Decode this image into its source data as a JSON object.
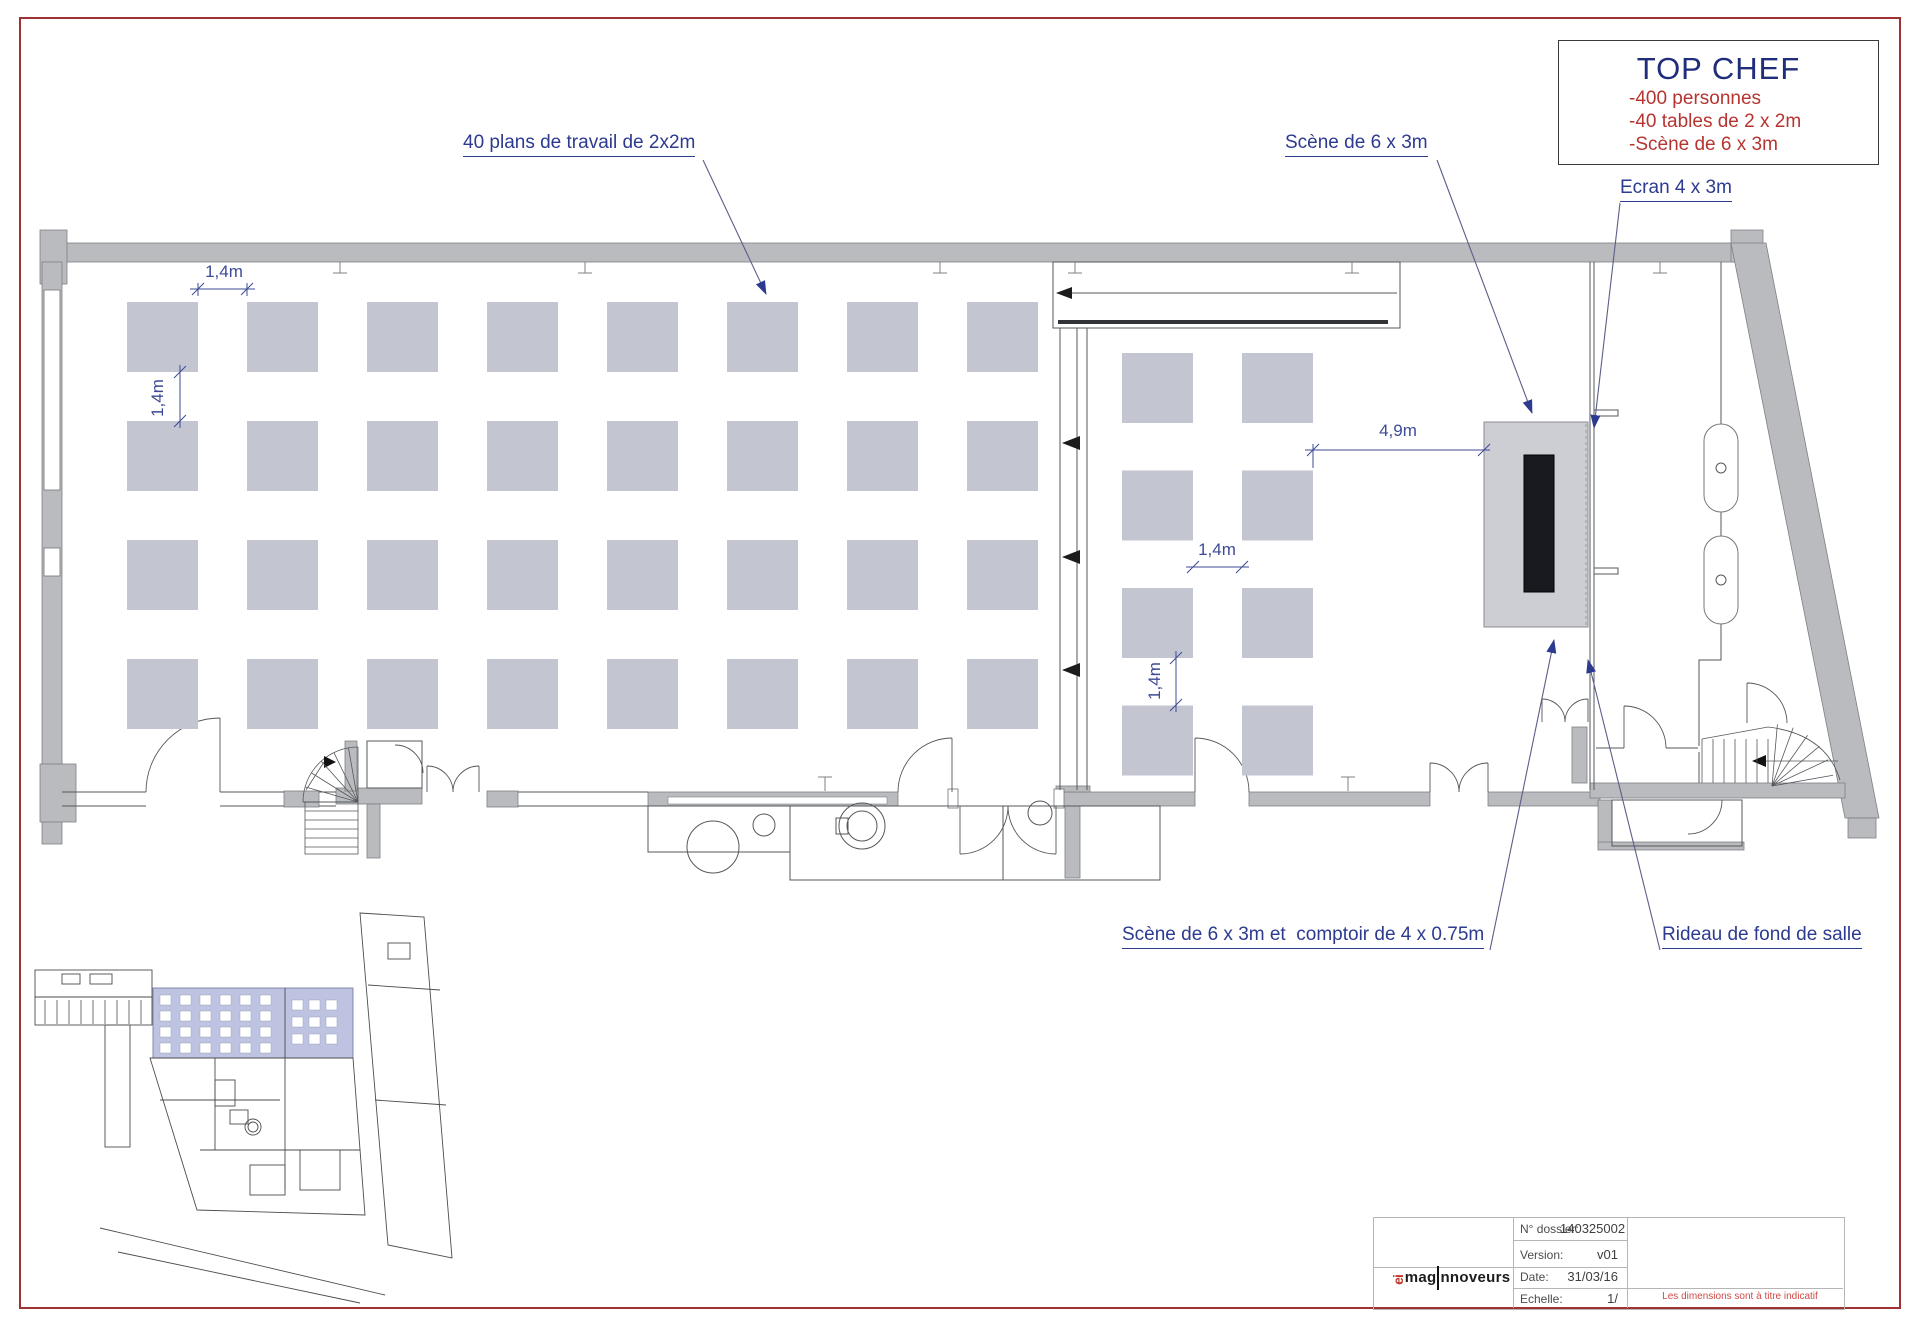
{
  "page": {
    "border_color": "#9e3132"
  },
  "title_box": {
    "title": "TOP CHEF",
    "lines": [
      "-400 personnes",
      "-40 tables de 2 x 2m",
      "-Scène de 6 x 3m"
    ]
  },
  "labels": {
    "work_tables": "40 plans de travail de 2x2m",
    "stage": "Scène de 6 x 3m",
    "screen": "Ecran 4 x 3m",
    "stage_counter": "Scène de 6 x 3m et  comptoir de 4 x 0.75m",
    "curtain": "Rideau de fond de salle"
  },
  "dimensions": {
    "table_gap_h": "1,4m",
    "table_gap_v": "1,4m",
    "mid_gap_h": "1,4m",
    "mid_gap_v": "1,4m",
    "stage_clearance": "4,9m"
  },
  "title_block": {
    "rows": [
      {
        "label": "N° dossier:",
        "value": "140325002"
      },
      {
        "label": "Version:",
        "value": "v01"
      },
      {
        "label": "Date:",
        "value": "31/03/16"
      },
      {
        "label": "Echelle:",
        "value": "1/"
      }
    ],
    "note": "Les dimensions sont à titre indicatif",
    "logo": {
      "mark": "ei",
      "left": "mag",
      "right": "nnoveurs"
    }
  },
  "colors": {
    "annotation": "#2c3a8f",
    "dimension": "#3d4a96",
    "red_text": "#b63430",
    "navy": "#1f2d7a",
    "wall": "#b9bbbe",
    "table": "#c3c6d1",
    "stage": "#cdced4",
    "screen": "#191a1f",
    "highlight": "#bdc3e0"
  }
}
